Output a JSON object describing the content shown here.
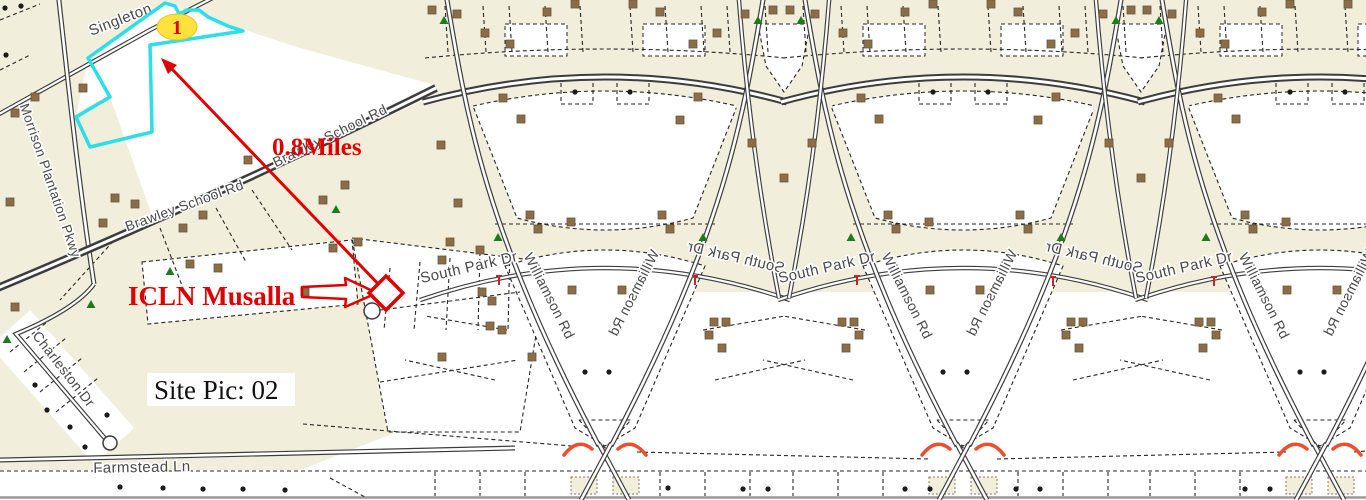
{
  "map": {
    "road_labels": {
      "singleton": "Singleton",
      "morrison": "Morrison Plantation Pkwy",
      "brawley": "Brawley School Rd",
      "south_park": "South Park Dr",
      "williamson": "Williamson Rd",
      "charleston": "Charleston Dr",
      "farmstead": "Farmstead Ln"
    },
    "annotations": {
      "marker_number": "1",
      "distance": "0.8Miles",
      "site_name": "ICLN Musalla",
      "site_pic": "Site Pic: 02"
    },
    "colors": {
      "background": "#f1eedc",
      "parcel_white": "#ffffff",
      "highlight_cyan": "#2bdfe9",
      "marker_yellow": "#ffe23d",
      "annotation_red": "#e00000",
      "crossing_red": "#e8502e",
      "house_brown": "#8a6e4a",
      "tree_green": "#1f7a1f",
      "label_gray": "#494949",
      "road_casing": "#3d3d3d",
      "bottom_line_gray": "#999999"
    }
  }
}
